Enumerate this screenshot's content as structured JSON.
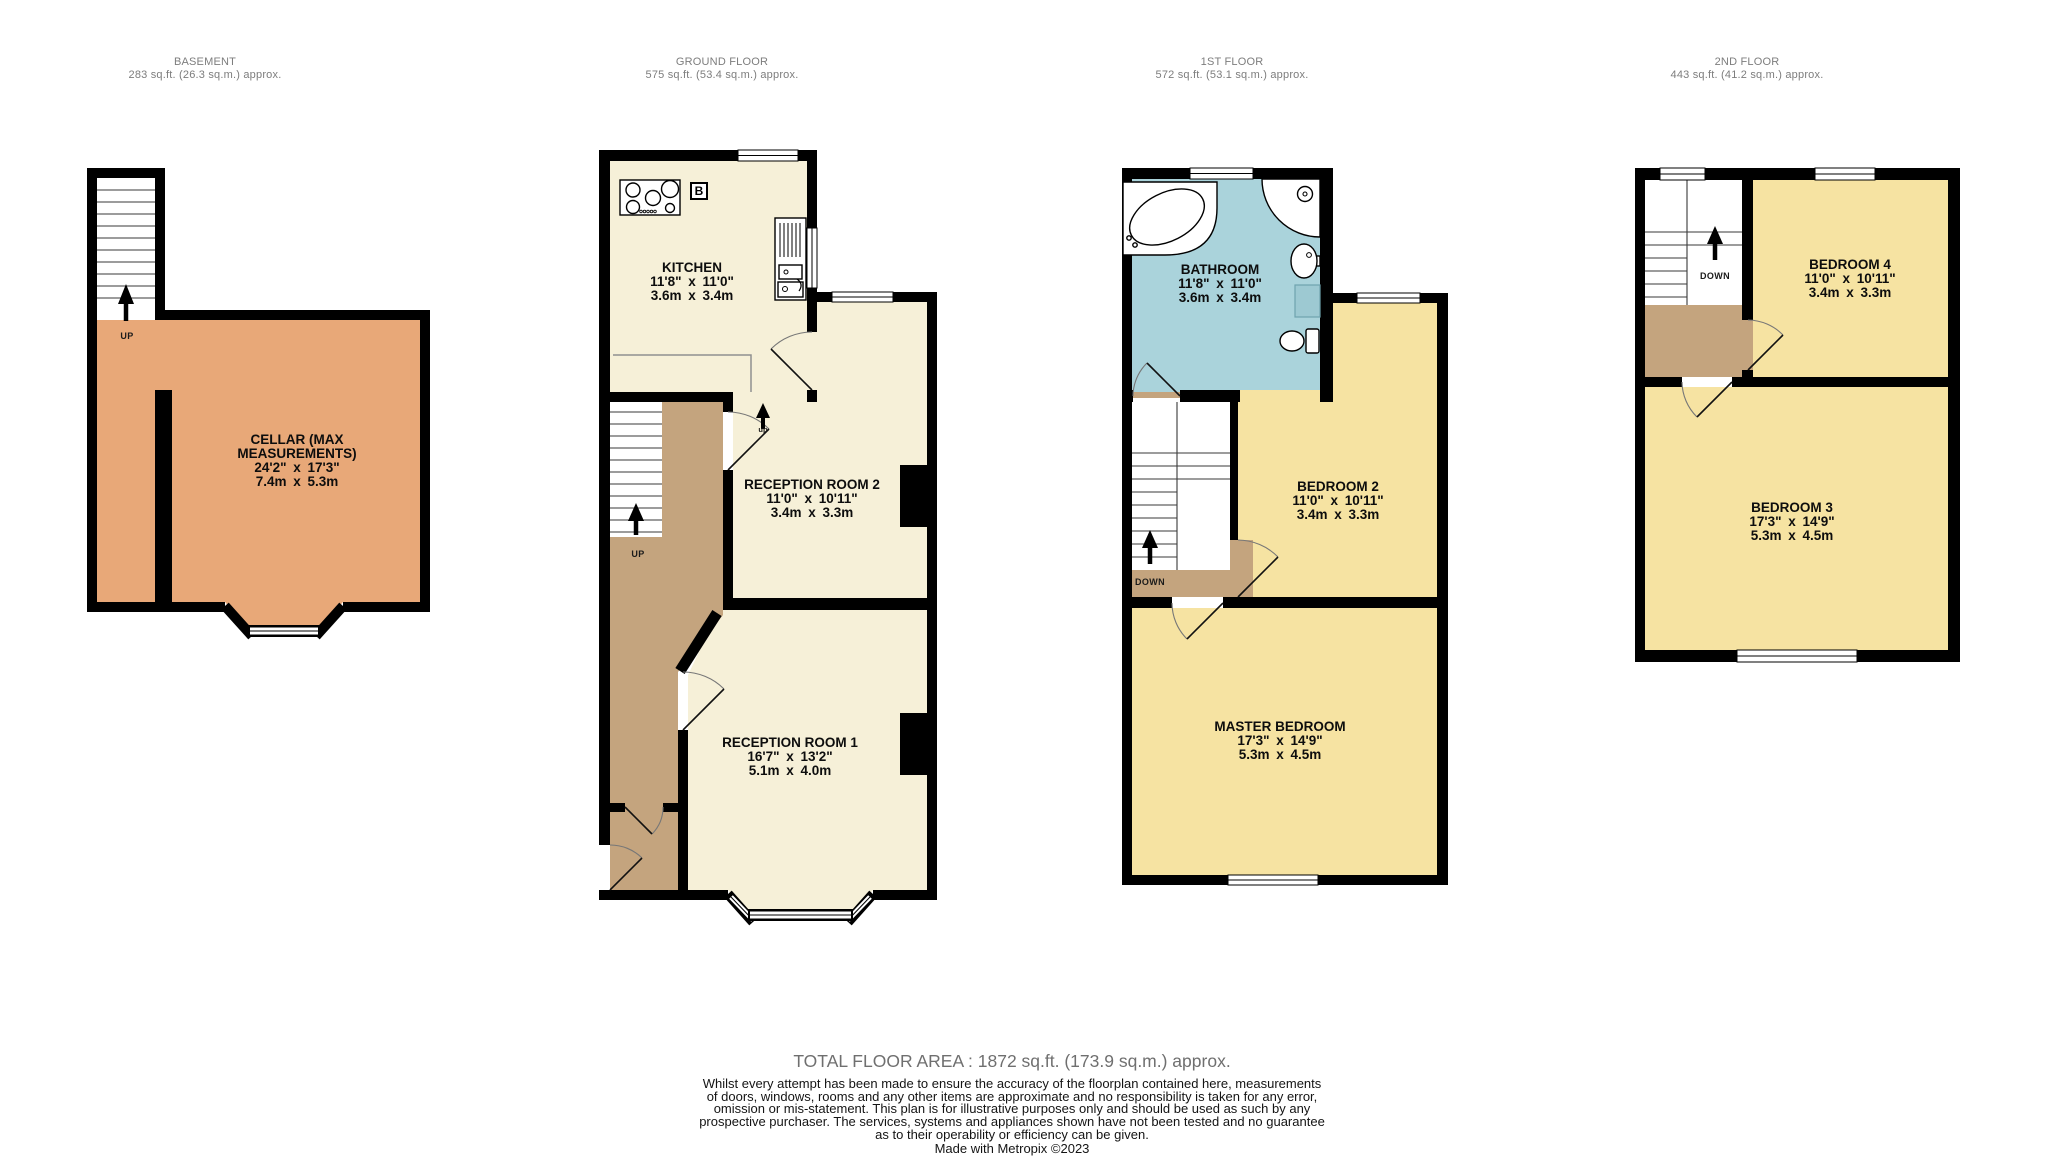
{
  "floors": [
    {
      "name": "BASEMENT",
      "area": "283 sq.ft. (26.3 sq.m.) approx."
    },
    {
      "name": "GROUND FLOOR",
      "area": "575 sq.ft. (53.4 sq.m.) approx."
    },
    {
      "name": "1ST FLOOR",
      "area": "572 sq.ft. (53.1 sq.m.) approx."
    },
    {
      "name": "2ND FLOOR",
      "area": "443 sq.ft. (41.2 sq.m.) approx."
    }
  ],
  "rooms": {
    "cellar": {
      "name": "CELLAR (MAX MEASUREMENTS)",
      "imperial": "24'2\" x 17'3\"",
      "metric": "7.4m x 5.3m"
    },
    "kitchen": {
      "name": "KITCHEN",
      "imperial": "11'8\" x 11'0\"",
      "metric": "3.6m x 3.4m"
    },
    "reception2": {
      "name": "RECEPTION ROOM 2",
      "imperial": "11'0\" x 10'11\"",
      "metric": "3.4m x 3.3m"
    },
    "reception1": {
      "name": "RECEPTION ROOM 1",
      "imperial": "16'7\" x 13'2\"",
      "metric": "5.1m x 4.0m"
    },
    "bathroom": {
      "name": "BATHROOM",
      "imperial": "11'8\" x 11'0\"",
      "metric": "3.6m x 3.4m"
    },
    "bedroom2": {
      "name": "BEDROOM 2",
      "imperial": "11'0\" x 10'11\"",
      "metric": "3.4m x 3.3m"
    },
    "master": {
      "name": "MASTER BEDROOM",
      "imperial": "17'3\" x 14'9\"",
      "metric": "5.3m x 4.5m"
    },
    "bedroom4": {
      "name": "BEDROOM 4",
      "imperial": "11'0\" x 10'11\"",
      "metric": "3.4m x 3.3m"
    },
    "bedroom3": {
      "name": "BEDROOM 3",
      "imperial": "17'3\" x 14'9\"",
      "metric": "5.3m x 4.5m"
    }
  },
  "stairs": {
    "basement_up": "UP",
    "ground_up": "UP",
    "ground_step_up": "up",
    "first_down": "DOWN",
    "second_down": "DOWN"
  },
  "boiler_label": "B",
  "footer": {
    "total": "TOTAL FLOOR AREA : 1872 sq.ft. (173.9 sq.m.) approx.",
    "disclaimer": "Whilst every attempt has been made to ensure the accuracy of the floorplan contained here, measurements\nof doors, windows, rooms and any other items are approximate and no responsibility is taken for any error,\nomission or mis-statement. This plan is for illustrative purposes only and should be used as such by any\nprospective purchaser. The services, systems and appliances shown have not been tested and no guarantee\nas to their operability or efficiency can be given.",
    "credit": "Made with Metropix ©2023"
  },
  "colors": {
    "wall": "#000000",
    "cellar": "#E8A878",
    "living": "#F6F0D8",
    "hall": "#C4A47E",
    "bedroom": "#F6E3A2",
    "bathroom": "#AAD3DB",
    "header_text": "#7d7d7d"
  }
}
